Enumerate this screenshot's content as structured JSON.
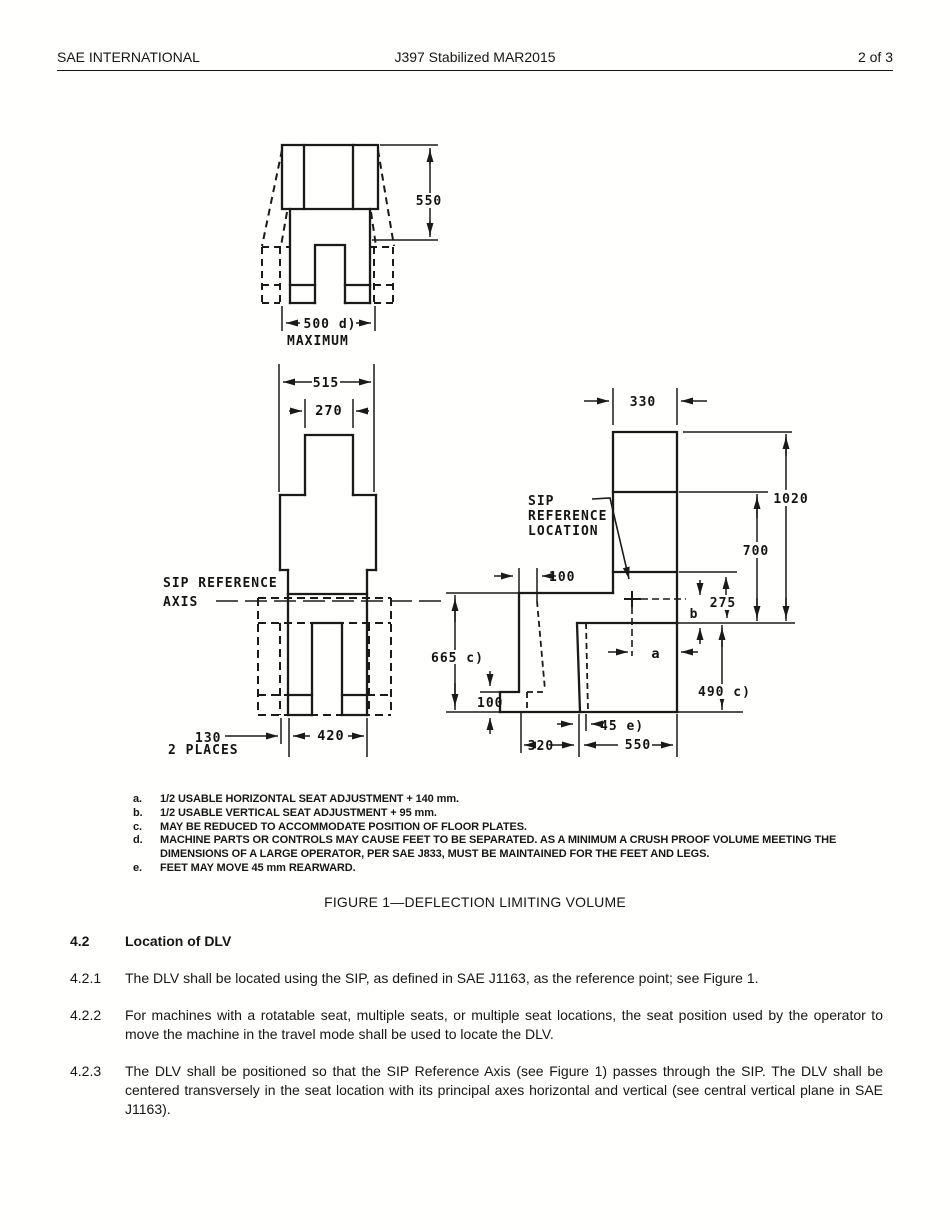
{
  "header": {
    "left": "SAE INTERNATIONAL",
    "center": "J397 Stabilized MAR2015",
    "right": "2 of 3"
  },
  "figure": {
    "caption": "FIGURE 1—DEFLECTION LIMITING VOLUME",
    "labels": {
      "front_height": "550",
      "front_width": "500 d)",
      "front_max": "MAXIMUM",
      "top_width": "515",
      "top_head": "270",
      "sip_axis_1": "SIP REFERENCE",
      "sip_axis_2": "AXIS",
      "top_130": "130",
      "top_130_note": "2 PLACES",
      "top_420": "420",
      "side_330": "330",
      "side_1020": "1020",
      "side_700": "700",
      "side_275": "275",
      "side_b": "b",
      "side_490": "490 c)",
      "side_a": "a",
      "side_100_top": "100",
      "side_665": "665 c)",
      "side_100_bot": "100",
      "side_45": "45 e)",
      "side_320": "320",
      "side_550": "550",
      "sip_loc_1": "SIP",
      "sip_loc_2": "REFERENCE",
      "sip_loc_3": "LOCATION"
    },
    "footnotes": [
      {
        "id": "a.",
        "text": "1/2 USABLE HORIZONTAL SEAT ADJUSTMENT + 140 mm."
      },
      {
        "id": "b.",
        "text": "1/2 USABLE VERTICAL SEAT ADJUSTMENT + 95 mm."
      },
      {
        "id": "c.",
        "text": "MAY BE REDUCED TO ACCOMMODATE POSITION OF FLOOR PLATES."
      },
      {
        "id": "d.",
        "text": "MACHINE PARTS OR CONTROLS MAY CAUSE FEET TO BE SEPARATED.  AS A MINIMUM A CRUSH PROOF VOLUME MEETING THE DIMENSIONS OF A LARGE OPERATOR, PER SAE J833, MUST BE MAINTAINED FOR THE FEET AND LEGS."
      },
      {
        "id": "e.",
        "text": "FEET MAY MOVE 45 mm REARWARD."
      }
    ]
  },
  "sections": [
    {
      "number": "4.2",
      "text": "Location of DLV"
    },
    {
      "number": "4.2.1",
      "text": "The DLV shall be located using the SIP, as defined in SAE J1163, as the reference point; see Figure 1."
    },
    {
      "number": "4.2.2",
      "text": "For machines with a rotatable seat, multiple seats, or multiple seat locations, the seat position used by the operator to move the machine in the travel mode shall be used to locate the DLV."
    },
    {
      "number": "4.2.3",
      "text": "The DLV shall be positioned so that the SIP Reference Axis (see Figure 1) passes through the SIP.  The DLV shall be centered transversely in the seat location with its principal axes horizontal and vertical (see central vertical plane in SAE J1163)."
    }
  ]
}
